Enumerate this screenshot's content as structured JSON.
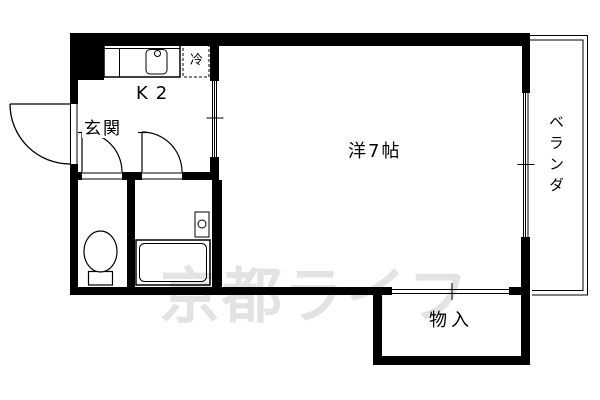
{
  "watermark": {
    "text": "京都ライフ",
    "color": "#e3e3e3"
  },
  "rooms": {
    "kitchen": {
      "label": "K2"
    },
    "entrance": {
      "label": "玄関"
    },
    "main": {
      "label": "洋7帖"
    },
    "veranda": {
      "label": "ベランダ"
    },
    "storage": {
      "label": "物入"
    }
  },
  "fixtures": {
    "refrigerator": {
      "label": "冷"
    }
  },
  "colors": {
    "line": "#000000",
    "background": "#ffffff"
  }
}
